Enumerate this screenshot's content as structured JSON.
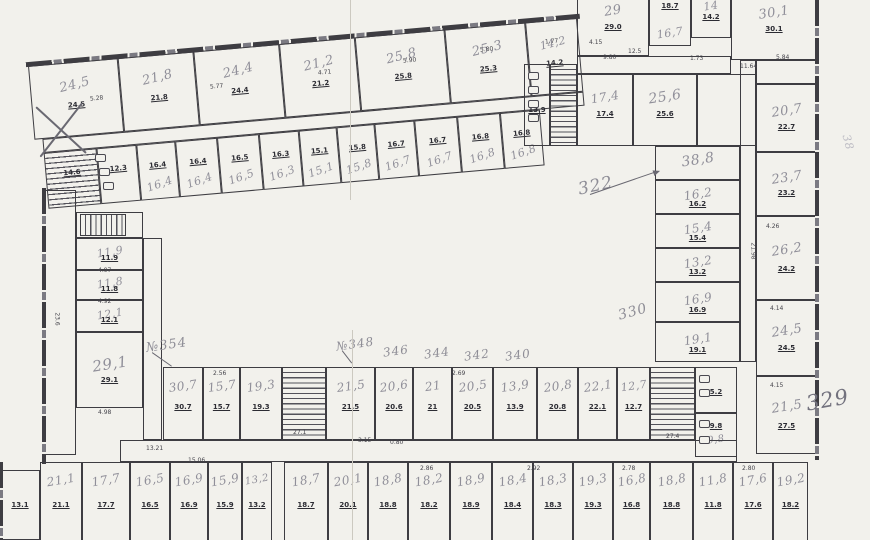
{
  "palette": {
    "paper": "#f2f1ec",
    "ink": "#3e3d42",
    "print": "#2c2c33",
    "pencil": "#8e8d96",
    "pencil_dark": "#73727e",
    "pencil_faint": "#bcbbc3"
  },
  "canvas": {
    "w": 870,
    "h": 540
  },
  "groups": [
    {
      "name": "top-wing-outer",
      "x": 28,
      "y": 66,
      "rot": -5,
      "fs": 13,
      "ly": 30,
      "sy": 58,
      "lr": -9,
      "walls": [
        {
          "x": -2,
          "y": -4,
          "w": 556,
          "h": 5,
          "dir": "h"
        }
      ],
      "rooms": [
        {
          "x": 0,
          "y": 0,
          "w": 90,
          "h": 74,
          "l": "24,5",
          "s": "24.5"
        },
        {
          "x": 90,
          "y": 0,
          "w": 76,
          "h": 74,
          "l": "21,8",
          "s": "21.8"
        },
        {
          "x": 166,
          "y": 0,
          "w": 86,
          "h": 74,
          "l": "24,4",
          "s": "24.4"
        },
        {
          "x": 252,
          "y": 0,
          "w": 76,
          "h": 74,
          "l": "21,2",
          "s": "21.2"
        },
        {
          "x": 328,
          "y": 0,
          "w": 90,
          "h": 74,
          "l": "25,8",
          "s": "25.8"
        },
        {
          "x": 418,
          "y": 0,
          "w": 81,
          "h": 74,
          "l": "25,3",
          "s": "25.3"
        },
        {
          "x": 499,
          "y": 0,
          "w": 52,
          "h": 74,
          "l": "14,2",
          "s": "14.2",
          "fs": 11
        },
        {
          "x": 8,
          "y": 74,
          "w": 543,
          "h": 14
        }
      ]
    },
    {
      "name": "top-wing-inner",
      "x": 28,
      "y": 66,
      "rot": -5,
      "fs": 11,
      "ly": 74,
      "sy": 38,
      "lr": -14,
      "rooms": [
        {
          "x": 8,
          "y": 88,
          "w": 53,
          "h": 56,
          "k": "stairs-h",
          "s": "14.6"
        },
        {
          "x": 61,
          "y": 88,
          "w": 40,
          "h": 56,
          "k": "wc",
          "s": "12.3"
        },
        {
          "x": 101,
          "y": 88,
          "w": 39,
          "h": 56,
          "l": "16,4",
          "s": "16.4"
        },
        {
          "x": 140,
          "y": 88,
          "w": 42,
          "h": 56,
          "l": "16,4",
          "s": "16.4"
        },
        {
          "x": 182,
          "y": 88,
          "w": 42,
          "h": 56,
          "l": "16,5",
          "s": "16.5"
        },
        {
          "x": 224,
          "y": 88,
          "w": 40,
          "h": 56,
          "l": "16,3",
          "s": "16.3"
        },
        {
          "x": 264,
          "y": 88,
          "w": 38,
          "h": 56,
          "l": "15,1",
          "s": "15.1"
        },
        {
          "x": 302,
          "y": 88,
          "w": 38,
          "h": 56,
          "l": "15,8",
          "s": "15.8"
        },
        {
          "x": 340,
          "y": 88,
          "w": 40,
          "h": 56,
          "l": "16,7",
          "s": "16.7"
        },
        {
          "x": 380,
          "y": 88,
          "w": 43,
          "h": 56,
          "l": "16,7",
          "s": "16.7"
        },
        {
          "x": 423,
          "y": 88,
          "w": 43,
          "h": 56,
          "l": "16,8",
          "s": "16.8"
        },
        {
          "x": 466,
          "y": 88,
          "w": 40,
          "h": 56,
          "l": "16,8",
          "s": "16.8"
        }
      ]
    },
    {
      "name": "right-top-block",
      "x": 0,
      "y": 0,
      "rot": 0,
      "fs": 13,
      "ly": 32,
      "sy": 56,
      "lr": -9,
      "rooms": [
        {
          "x": 577,
          "y": -10,
          "w": 72,
          "h": 66,
          "l": "29",
          "s": "29.0"
        },
        {
          "x": 649,
          "y": -10,
          "w": 42,
          "h": 56,
          "l": "16,7",
          "s": "18.7",
          "ly": 78,
          "sy": 28,
          "fs": 11
        },
        {
          "x": 691,
          "y": -10,
          "w": 40,
          "h": 48,
          "l": "14",
          "s": "14.2",
          "fs": 11
        },
        {
          "x": 731,
          "y": -10,
          "w": 86,
          "h": 70,
          "l": "30,1",
          "s": "30.1"
        },
        {
          "x": 577,
          "y": 56,
          "w": 154,
          "h": 18
        },
        {
          "x": 524,
          "y": 64,
          "w": 26,
          "h": 82,
          "k": "wc",
          "s": "13.9"
        },
        {
          "x": 550,
          "y": 64,
          "w": 27,
          "h": 82,
          "k": "stairs-h"
        },
        {
          "x": 577,
          "y": 74,
          "w": 56,
          "h": 72,
          "l": "17,4",
          "s": "17.4",
          "fs": 12
        },
        {
          "x": 633,
          "y": 74,
          "w": 64,
          "h": 72,
          "l": "25,6",
          "s": "25.6",
          "fs": 14
        },
        {
          "x": 697,
          "y": 74,
          "w": 59,
          "h": 72
        }
      ]
    },
    {
      "name": "right-wing-inner",
      "x": 0,
      "y": 0,
      "rot": 0,
      "fs": 12,
      "ly": 42,
      "sy": 72,
      "lr": -9,
      "rooms": [
        {
          "x": 655,
          "y": 146,
          "w": 85,
          "h": 34,
          "l": "38,8",
          "fs": 14
        },
        {
          "x": 655,
          "y": 180,
          "w": 85,
          "h": 34,
          "l": "16,2",
          "s": "16.2"
        },
        {
          "x": 655,
          "y": 214,
          "w": 85,
          "h": 34,
          "l": "15,4",
          "s": "15.4"
        },
        {
          "x": 655,
          "y": 248,
          "w": 85,
          "h": 34,
          "l": "13,2",
          "s": "13.2"
        },
        {
          "x": 655,
          "y": 282,
          "w": 85,
          "h": 40,
          "l": "16,9",
          "s": "16.9"
        },
        {
          "x": 655,
          "y": 322,
          "w": 85,
          "h": 40,
          "l": "19,1",
          "s": "19.1"
        },
        {
          "x": 740,
          "y": 60,
          "w": 16,
          "h": 302
        }
      ]
    },
    {
      "name": "right-wing-outer",
      "x": 0,
      "y": 0,
      "rot": 0,
      "fs": 13,
      "ly": 40,
      "sy": 64,
      "lr": -9,
      "rooms": [
        {
          "x": 756,
          "y": 60,
          "w": 61,
          "h": 24
        },
        {
          "x": 756,
          "y": 84,
          "w": 61,
          "h": 68,
          "l": "20,7",
          "s": "22.7"
        },
        {
          "x": 756,
          "y": 152,
          "w": 61,
          "h": 64,
          "l": "23,7",
          "s": "23.2"
        },
        {
          "x": 756,
          "y": 216,
          "w": 61,
          "h": 84,
          "l": "26,2",
          "s": "24.2"
        },
        {
          "x": 756,
          "y": 300,
          "w": 61,
          "h": 76,
          "l": "24,5",
          "s": "24.5"
        },
        {
          "x": 756,
          "y": 376,
          "w": 61,
          "h": 78,
          "l": "21,5",
          "s": "27.5"
        }
      ]
    },
    {
      "name": "left-wing",
      "x": 0,
      "y": 0,
      "rot": 0,
      "fs": 11,
      "ly": 42,
      "sy": 64,
      "lr": -9,
      "rooms": [
        {
          "x": 44,
          "y": 190,
          "w": 32,
          "h": 265
        },
        {
          "x": 76,
          "y": 212,
          "w": 67,
          "h": 26
        },
        {
          "x": 80,
          "y": 214,
          "w": 46,
          "h": 22,
          "k": "stairs-v"
        },
        {
          "x": 76,
          "y": 238,
          "w": 67,
          "h": 32,
          "l": "11,9",
          "s": "11.9"
        },
        {
          "x": 76,
          "y": 270,
          "w": 67,
          "h": 30,
          "l": "11,8",
          "s": "11.8"
        },
        {
          "x": 76,
          "y": 300,
          "w": 67,
          "h": 32,
          "l": "12,1",
          "s": "12.1"
        },
        {
          "x": 76,
          "y": 332,
          "w": 67,
          "h": 76,
          "l": "29,1",
          "s": "29.1",
          "fs": 15
        },
        {
          "x": 143,
          "y": 238,
          "w": 19,
          "h": 202
        }
      ]
    },
    {
      "name": "bottom-wing",
      "x": 0,
      "y": 0,
      "rot": 0,
      "fs": 12,
      "ly": 26,
      "sy": 55,
      "lr": -8,
      "rooms": [
        {
          "x": 163,
          "y": 367,
          "w": 40,
          "h": 73,
          "l": "30,7",
          "s": "30.7"
        },
        {
          "x": 203,
          "y": 367,
          "w": 37,
          "h": 73,
          "l": "15,7",
          "s": "15.7"
        },
        {
          "x": 240,
          "y": 367,
          "w": 42,
          "h": 73,
          "l": "19,3",
          "s": "19.3"
        },
        {
          "x": 282,
          "y": 367,
          "w": 44,
          "h": 73,
          "k": "stairs-h"
        },
        {
          "x": 326,
          "y": 367,
          "w": 49,
          "h": 73,
          "l": "21,5",
          "s": "21.5"
        },
        {
          "x": 375,
          "y": 367,
          "w": 38,
          "h": 73,
          "l": "20,6",
          "s": "20.6"
        },
        {
          "x": 413,
          "y": 367,
          "w": 39,
          "h": 73,
          "l": "21",
          "s": "21"
        },
        {
          "x": 452,
          "y": 367,
          "w": 41,
          "h": 73,
          "l": "20,5",
          "s": "20.5"
        },
        {
          "x": 493,
          "y": 367,
          "w": 44,
          "h": 73,
          "l": "13,9",
          "s": "13.9"
        },
        {
          "x": 537,
          "y": 367,
          "w": 41,
          "h": 73,
          "l": "20,8",
          "s": "20.8"
        },
        {
          "x": 578,
          "y": 367,
          "w": 39,
          "h": 73,
          "l": "22,1",
          "s": "22.1"
        },
        {
          "x": 617,
          "y": 367,
          "w": 33,
          "h": 73,
          "l": "12,7",
          "s": "12.7",
          "fs": 11
        },
        {
          "x": 650,
          "y": 367,
          "w": 45,
          "h": 73,
          "k": "stairs-h"
        },
        {
          "x": 695,
          "y": 367,
          "w": 42,
          "h": 46,
          "k": "wc",
          "s": "5.2"
        },
        {
          "x": 695,
          "y": 413,
          "w": 42,
          "h": 44,
          "k": "wc",
          "l": "9,8",
          "s": "9.8",
          "ly": 62,
          "sy": 28,
          "fs": 10
        },
        {
          "x": 120,
          "y": 440,
          "w": 617,
          "h": 22
        }
      ]
    },
    {
      "name": "bottom-outer-row",
      "x": 0,
      "y": 0,
      "rot": 0,
      "fs": 12,
      "ly": 20,
      "sy": 50,
      "lr": -10,
      "rooms": [
        {
          "x": 0,
          "y": 470,
          "w": 40,
          "h": 70,
          "s": "13.1"
        },
        {
          "x": 40,
          "y": 462,
          "w": 42,
          "h": 85,
          "l": "21,1",
          "s": "21.1"
        },
        {
          "x": 82,
          "y": 462,
          "w": 48,
          "h": 85,
          "l": "17,7",
          "s": "17.7"
        },
        {
          "x": 130,
          "y": 462,
          "w": 40,
          "h": 85,
          "l": "16,5",
          "s": "16.5"
        },
        {
          "x": 170,
          "y": 462,
          "w": 38,
          "h": 85,
          "l": "16,9",
          "s": "16.9"
        },
        {
          "x": 208,
          "y": 462,
          "w": 34,
          "h": 85,
          "l": "15,9",
          "s": "15.9"
        },
        {
          "x": 242,
          "y": 462,
          "w": 30,
          "h": 85,
          "l": "13,2",
          "s": "13.2",
          "fs": 10
        },
        {
          "x": 284,
          "y": 462,
          "w": 44,
          "h": 85,
          "l": "18,7",
          "s": "18.7"
        },
        {
          "x": 328,
          "y": 462,
          "w": 40,
          "h": 85,
          "l": "20,1",
          "s": "20.1"
        },
        {
          "x": 368,
          "y": 462,
          "w": 40,
          "h": 85,
          "l": "18,8",
          "s": "18.8"
        },
        {
          "x": 408,
          "y": 462,
          "w": 42,
          "h": 85,
          "l": "18,2",
          "s": "18.2"
        },
        {
          "x": 450,
          "y": 462,
          "w": 42,
          "h": 85,
          "l": "18,9",
          "s": "18.9"
        },
        {
          "x": 492,
          "y": 462,
          "w": 41,
          "h": 85,
          "l": "18,4",
          "s": "18.4"
        },
        {
          "x": 533,
          "y": 462,
          "w": 40,
          "h": 85,
          "l": "18,3",
          "s": "18.3"
        },
        {
          "x": 573,
          "y": 462,
          "w": 40,
          "h": 85,
          "l": "19,3",
          "s": "19.3"
        },
        {
          "x": 613,
          "y": 462,
          "w": 37,
          "h": 85,
          "l": "16,8",
          "s": "16.8"
        },
        {
          "x": 650,
          "y": 462,
          "w": 43,
          "h": 85,
          "l": "18,8",
          "s": "18.8"
        },
        {
          "x": 693,
          "y": 462,
          "w": 40,
          "h": 85,
          "l": "11,8",
          "s": "11.8"
        },
        {
          "x": 733,
          "y": 462,
          "w": 40,
          "h": 85,
          "l": "17,6",
          "s": "17.6"
        },
        {
          "x": 773,
          "y": 462,
          "w": 35,
          "h": 85,
          "l": "19,2",
          "s": "18.2"
        }
      ]
    }
  ],
  "walls": [
    {
      "x": 815,
      "y": 0,
      "w": 4,
      "h": 460,
      "dir": "v"
    },
    {
      "x": 42,
      "y": 188,
      "w": 4,
      "h": 276,
      "dir": "v"
    },
    {
      "x": -1,
      "y": 462,
      "w": 4,
      "h": 78,
      "dir": "v"
    }
  ],
  "annotations": [
    {
      "t": "322",
      "x": 578,
      "y": 176,
      "fs": 17,
      "rot": -12
    },
    {
      "t": "№354",
      "x": 146,
      "y": 338,
      "fs": 13,
      "rot": -8
    },
    {
      "t": "№348",
      "x": 336,
      "y": 337,
      "fs": 12,
      "rot": -8
    },
    {
      "t": "346",
      "x": 383,
      "y": 344,
      "fs": 12,
      "rot": -8
    },
    {
      "t": "344",
      "x": 424,
      "y": 346,
      "fs": 12,
      "rot": -8
    },
    {
      "t": "342",
      "x": 464,
      "y": 348,
      "fs": 12,
      "rot": -8
    },
    {
      "t": "340",
      "x": 505,
      "y": 348,
      "fs": 12,
      "rot": -8
    },
    {
      "t": "330",
      "x": 618,
      "y": 304,
      "fs": 14,
      "rot": -15
    },
    {
      "t": "329",
      "x": 806,
      "y": 388,
      "fs": 21,
      "rot": -10,
      "c": "#73727e"
    },
    {
      "t": "38",
      "x": 840,
      "y": 136,
      "fs": 11,
      "rot": 75,
      "c": "#bcbbc3"
    }
  ],
  "lines": [
    {
      "x1": 36,
      "y1": 106,
      "x2": 86,
      "y2": 152,
      "w": 2.2
    },
    {
      "x1": 82,
      "y1": 102,
      "x2": 40,
      "y2": 156,
      "w": 2.2
    },
    {
      "x1": 590,
      "y1": 194,
      "x2": 654,
      "y2": 172,
      "w": 1.4,
      "arrow": true
    },
    {
      "x1": 152,
      "y1": 352,
      "x2": 172,
      "y2": 366,
      "w": 1.2
    },
    {
      "x1": 342,
      "y1": 350,
      "x2": 352,
      "y2": 363,
      "w": 1.2
    }
  ],
  "dims": [
    {
      "t": "5.28",
      "x": 90,
      "y": 96,
      "r": -5
    },
    {
      "t": "5.77",
      "x": 210,
      "y": 84,
      "r": -5
    },
    {
      "t": "4.71",
      "x": 318,
      "y": 70,
      "r": -5
    },
    {
      "t": "5.90",
      "x": 403,
      "y": 58,
      "r": -5
    },
    {
      "t": "5.80",
      "x": 480,
      "y": 47,
      "r": -5
    },
    {
      "t": "1.77",
      "x": 545,
      "y": 39,
      "r": -5
    },
    {
      "t": "4.15",
      "x": 589,
      "y": 40,
      "r": 0
    },
    {
      "t": "9.80",
      "x": 603,
      "y": 55,
      "r": 0
    },
    {
      "t": "12.5",
      "x": 628,
      "y": 49,
      "r": 0
    },
    {
      "t": "1.73",
      "x": 690,
      "y": 56,
      "r": 0
    },
    {
      "t": "11.64",
      "x": 740,
      "y": 64,
      "r": 0
    },
    {
      "t": "5.84",
      "x": 776,
      "y": 55,
      "r": 0
    },
    {
      "t": "21.98",
      "x": 744,
      "y": 248,
      "r": 90
    },
    {
      "t": "4.26",
      "x": 766,
      "y": 224,
      "r": 0
    },
    {
      "t": "4.14",
      "x": 770,
      "y": 306,
      "r": 0
    },
    {
      "t": "4.15",
      "x": 770,
      "y": 383,
      "r": 0
    },
    {
      "t": "2.56",
      "x": 213,
      "y": 371,
      "r": 0
    },
    {
      "t": "2.69",
      "x": 452,
      "y": 371,
      "r": 0
    },
    {
      "t": "13.21",
      "x": 146,
      "y": 446,
      "r": 0
    },
    {
      "t": "15.06",
      "x": 188,
      "y": 458,
      "r": 0
    },
    {
      "t": "3.15",
      "x": 358,
      "y": 438,
      "r": 0
    },
    {
      "t": "0.80",
      "x": 390,
      "y": 440,
      "r": 0
    },
    {
      "t": "27.1",
      "x": 293,
      "y": 430,
      "r": 0
    },
    {
      "t": "27.4",
      "x": 666,
      "y": 434,
      "r": 0
    },
    {
      "t": "4.97",
      "x": 98,
      "y": 268,
      "r": 0
    },
    {
      "t": "4.92",
      "x": 98,
      "y": 299,
      "r": 0
    },
    {
      "t": "4.98",
      "x": 98,
      "y": 410,
      "r": 0
    },
    {
      "t": "23.6",
      "x": 50,
      "y": 316,
      "r": 90
    },
    {
      "t": "2.86",
      "x": 420,
      "y": 466,
      "r": 0
    },
    {
      "t": "2.92",
      "x": 527,
      "y": 466,
      "r": 0
    },
    {
      "t": "2.78",
      "x": 622,
      "y": 466,
      "r": 0
    },
    {
      "t": "2.80",
      "x": 742,
      "y": 466,
      "r": 0
    }
  ],
  "fixtures": [
    {
      "x": 95,
      "y": 154,
      "w": 11,
      "h": 8
    },
    {
      "x": 99,
      "y": 168,
      "w": 11,
      "h": 8
    },
    {
      "x": 103,
      "y": 182,
      "w": 11,
      "h": 8
    },
    {
      "x": 528,
      "y": 72,
      "w": 11,
      "h": 8
    },
    {
      "x": 528,
      "y": 86,
      "w": 11,
      "h": 8
    },
    {
      "x": 528,
      "y": 100,
      "w": 11,
      "h": 8
    },
    {
      "x": 528,
      "y": 114,
      "w": 11,
      "h": 8
    },
    {
      "x": 699,
      "y": 375,
      "w": 11,
      "h": 8
    },
    {
      "x": 699,
      "y": 389,
      "w": 11,
      "h": 8
    },
    {
      "x": 699,
      "y": 420,
      "w": 11,
      "h": 8
    },
    {
      "x": 699,
      "y": 436,
      "w": 11,
      "h": 8
    }
  ],
  "seams": [
    {
      "x": 350,
      "y": 0,
      "h": 200
    },
    {
      "x": 352,
      "y": 330,
      "h": 210
    }
  ]
}
